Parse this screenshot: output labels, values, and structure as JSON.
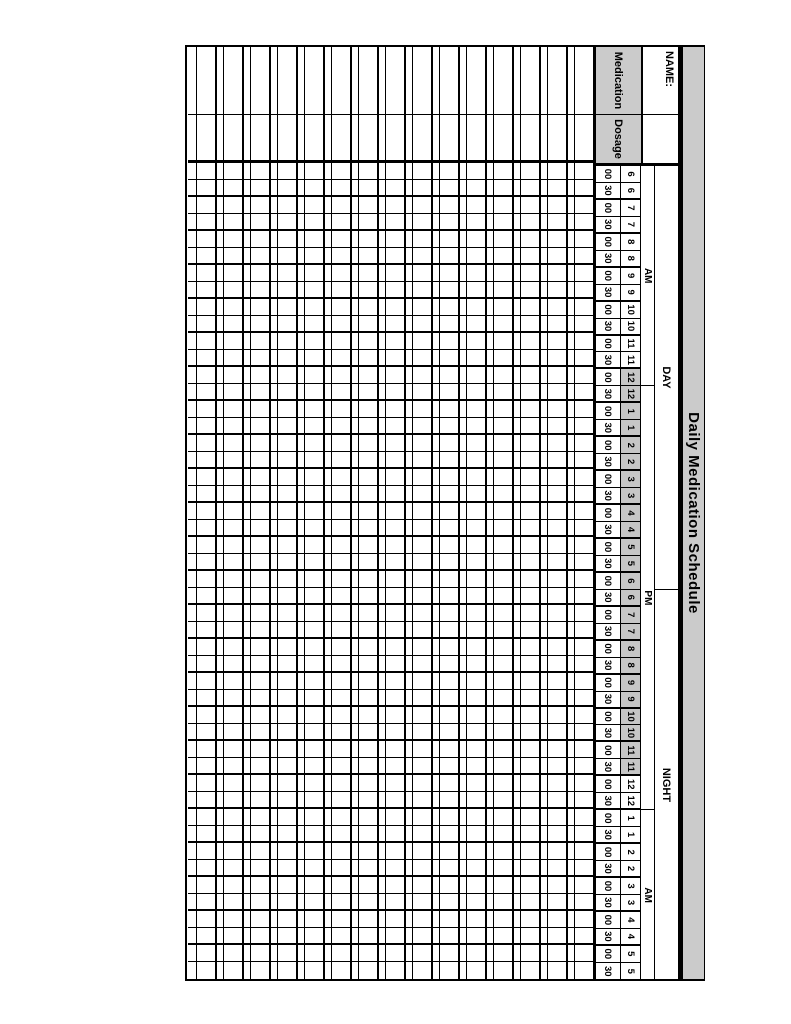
{
  "title": "Daily Medication Schedule",
  "name_row": {
    "label": "NAME:"
  },
  "columns": {
    "medication": "Medication",
    "dosage": "Dosage"
  },
  "time_header": {
    "outer_groups": [
      {
        "label": "DAY",
        "span_half_hours": 25
      },
      {
        "label": "NIGHT",
        "span_half_hours": 23
      }
    ],
    "inner_groups": [
      {
        "label": "AM",
        "span_half_hours": 13
      },
      {
        "label": "PM",
        "span_half_hours": 25
      },
      {
        "label": "AM",
        "span_half_hours": 10
      }
    ],
    "hours": [
      "6",
      "7",
      "8",
      "9",
      "10",
      "11",
      "12",
      "1",
      "2",
      "3",
      "4",
      "5",
      "6",
      "7",
      "8",
      "9",
      "10",
      "11",
      "12",
      "1",
      "2",
      "3",
      "4",
      "5"
    ],
    "minutes": [
      "00",
      "30"
    ],
    "shaded_half_hour_range": [
      12,
      35
    ]
  },
  "body": {
    "medication_row_groups": 15
  },
  "colors": {
    "header_gray": "#cbcbcb",
    "shaded_hour_gray": "#c6c6c6",
    "line": "#000000"
  }
}
